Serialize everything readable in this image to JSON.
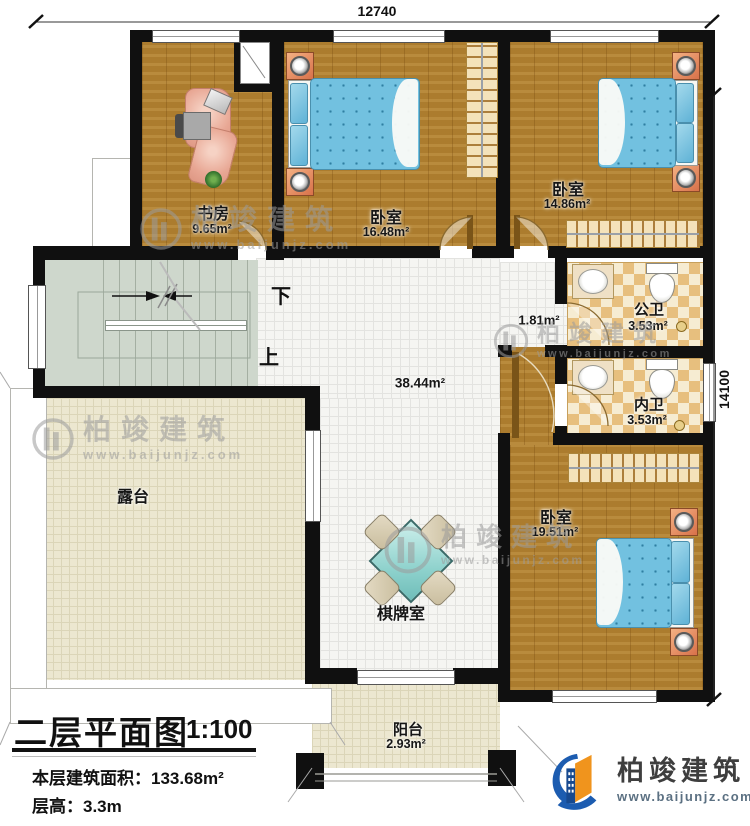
{
  "dimensions": {
    "width_label": "12740",
    "height_label": "14100"
  },
  "rooms": {
    "study": {
      "name": "书房",
      "area": "9.65m²"
    },
    "bedroom1": {
      "name": "卧室",
      "area": "16.48m²"
    },
    "bedroom2": {
      "name": "卧室",
      "area": "14.86m²"
    },
    "bedroom3": {
      "name": "卧室",
      "area": "19.51m²"
    },
    "public_bath": {
      "name": "公卫",
      "area": "3.53m²"
    },
    "ensuite_bath": {
      "name": "内卫",
      "area": "3.53m²"
    },
    "hall": {
      "area": "38.44m²"
    },
    "corridor": {
      "area": "1.81m²"
    },
    "terrace": {
      "name": "露台"
    },
    "game_room": {
      "name": "棋牌室"
    },
    "balcony": {
      "name": "阳台",
      "area": "2.93m²"
    }
  },
  "stairs": {
    "down_label": "下",
    "up_label": "上"
  },
  "title_block": {
    "title": "二层平面图",
    "scale": "1:100",
    "floor_area_line": "本层建筑面积：133.68m²",
    "floor_height_line": "层高：3.3m"
  },
  "branding": {
    "watermark_name": "柏竣建筑",
    "watermark_url": "www.baijunjz.com",
    "logo_name": "柏竣建筑",
    "logo_url": "www.baijunjz.com"
  },
  "colors": {
    "wall": "#101010",
    "wood_floor": "#b1802f",
    "mattress_blue": "#72c1e0",
    "bath_tile": "#e7bf7e",
    "stair_green": "#ced7cc",
    "terrace_cream": "#ece7d0",
    "logo_blue": "#1c5cb0",
    "logo_orange": "#f0941d"
  }
}
